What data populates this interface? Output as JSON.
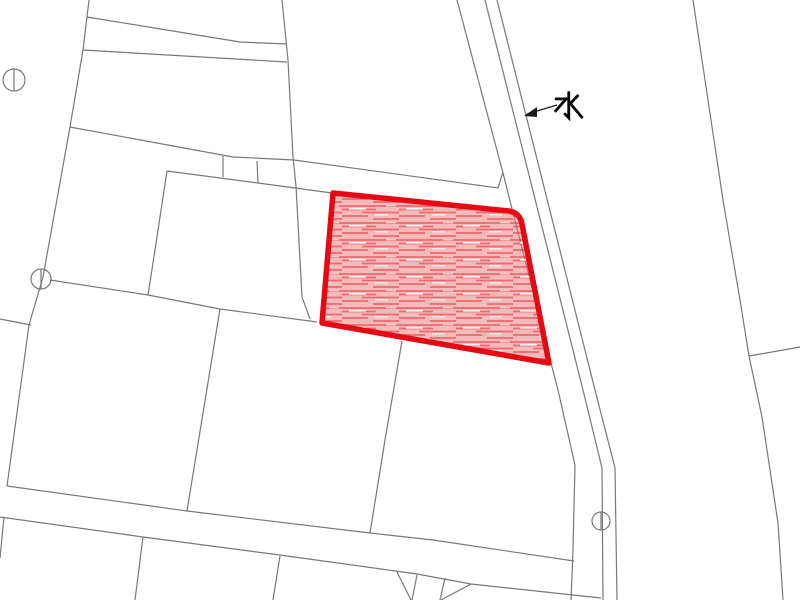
{
  "window": {
    "width": 800,
    "height": 600,
    "background": "#ffffff"
  },
  "map": {
    "type": "cadastral-parcel-map",
    "line_color": "#787878",
    "line_width": 1.2,
    "water_label": {
      "text": "水",
      "x": 553,
      "y": 91,
      "color": "#000000",
      "font_size": 32
    },
    "arrow": {
      "tail": [
        557,
        105
      ],
      "tip": [
        527,
        114
      ],
      "head_points": "524,116 537,107 537,117",
      "color": "#1a1a1a"
    },
    "highlight_parcel": {
      "stroke": "#e50914",
      "stroke_width": 5.5,
      "fill_base": "rgba(238,118,120,0.50)",
      "hatch_color": "rgba(219,26,38,0.50)",
      "path": "M333,193 L509,211 Q520,213 522,224 L549,363 L322,323 Z"
    },
    "survey_markers": [
      {
        "name": "survey-marker-top-left",
        "cx": 14,
        "cy": 80,
        "r": 11
      },
      {
        "name": "survey-marker-mid-left",
        "cx": 41,
        "cy": 279,
        "r": 10
      },
      {
        "name": "survey-marker-waterway",
        "cx": 601,
        "cy": 521,
        "r": 9
      }
    ],
    "boundary_lines": [
      {
        "name": "boundary-left-long",
        "points": "89,0 83,50 70,127 43,277 29,325 7,486"
      },
      {
        "name": "road-upper-strip-top",
        "points": "87,17 240,42 287,44"
      },
      {
        "name": "road-upper-strip-bottom",
        "points": "83,50 287,62"
      },
      {
        "name": "boundary-vertical-2",
        "points": "282,0 288,60 293,157 296,186 302,297 310,319"
      },
      {
        "name": "road-middle-strip-top",
        "points": "70,127 233,157 294,160 498,188 503,172"
      },
      {
        "name": "road-middle-strip-bottom",
        "points": "167,171 258,183 332,193"
      },
      {
        "name": "strip-notch-left",
        "points": "223,156 223,177"
      },
      {
        "name": "strip-notch-right",
        "points": "257,161 258,183"
      },
      {
        "name": "boundary-vertical-1",
        "points": "167,171 155,250 148,295"
      },
      {
        "name": "boundary-horizontal-mid",
        "points": "50,280 148,295 220,309 317,322"
      },
      {
        "name": "boundary-diagonal-mid",
        "points": "220,309 187,511"
      },
      {
        "name": "boundary-left-edge-stub",
        "points": "0,319 31,325"
      },
      {
        "name": "road-lower-top",
        "points": "7,486 187,511 370,533 433,540 574,561"
      },
      {
        "name": "road-lower-bottom",
        "points": "0,517 143,537 280,555 417,574 471,584 601,598"
      },
      {
        "name": "boundary-left-bottom-stub",
        "points": "4,517 0,558"
      },
      {
        "name": "boundary-below-road-1",
        "points": "143,537 135,600"
      },
      {
        "name": "boundary-below-road-2",
        "points": "280,556 273,600"
      },
      {
        "name": "small-lot-a-diagonal",
        "points": "397,572 411,600"
      },
      {
        "name": "small-lot-a-side",
        "points": "417,575 412,600"
      },
      {
        "name": "small-lot-b-side",
        "points": "445,578 440,600"
      },
      {
        "name": "small-lot-b-diagonal",
        "points": "471,584 441,600"
      },
      {
        "name": "boundary-below-parcel",
        "points": "402,341 385,440 370,533"
      },
      {
        "name": "waterway-west-boundary",
        "points": "457,0 503,173 551,363 558,390 575,465 573,550 571,600"
      },
      {
        "name": "waterway-line-left",
        "points": "485,0 583,390 602,468 603,600"
      },
      {
        "name": "waterway-line-right",
        "points": "497,0 595,390 615,468 617,600"
      },
      {
        "name": "boundary-right-long",
        "points": "693,0 723,200 740,300 749,356 762,417 778,523 783,600"
      },
      {
        "name": "boundary-right-branch",
        "points": "749,356 800,347"
      }
    ]
  }
}
